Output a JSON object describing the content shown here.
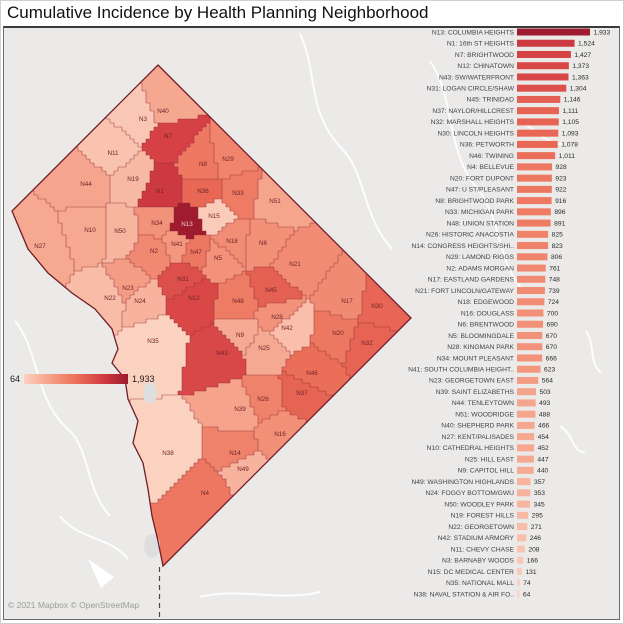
{
  "title": "Cumulative Incidence by Health Planning Neighborhood",
  "attribution": "© 2021 Mapbox © OpenStreetMap",
  "legend": {
    "min_label": "64",
    "max_label": "1,933"
  },
  "color_scale": {
    "stops": [
      "#fbd2c0",
      "#f5a088",
      "#ec7059",
      "#d43d43",
      "#9e1b30"
    ],
    "domain": [
      64,
      1933
    ]
  },
  "chart_data": {
    "type": "bar",
    "orientation": "horizontal",
    "title": "Cumulative Incidence by Health Planning Neighborhood",
    "xlabel": "",
    "ylabel": "",
    "xlim": [
      0,
      1933
    ],
    "grid": false,
    "legend_position": "none",
    "categories": [
      "N13: COLUMBIA HEIGHTS",
      "N1: 16th ST HEIGHTS",
      "N7: BRIGHTWOOD",
      "N12: CHINATOWN",
      "N43: SW/WATERFRONT",
      "N31: LOGAN CIRCLE/SHAW",
      "N45: TRINIDAD",
      "N37: NAYLOR/HILLCREST",
      "N32: MARSHALL HEIGHTS",
      "N30: LINCOLN HEIGHTS",
      "N36: PETWORTH",
      "N46: TWINING",
      "N4: BELLEVUE",
      "N20: FORT DUPONT",
      "N47: U ST/PLEASANT",
      "N8: BRIGHTWOOD PARK",
      "N33: MICHIGAN PARK",
      "N48: UNION STATION",
      "N26: HISTORIC ANACOSTIA",
      "N14: CONGRESS HEIGHTS/SHI..",
      "N29: LAMOND RIGGS",
      "N2: ADAMS MORGAN",
      "N17: EASTLAND GARDENS",
      "N21: FORT LINCOLN/GATEWAY",
      "N18: EDGEWOOD",
      "N16: DOUGLASS",
      "N6: BRENTWOOD",
      "N5: BLOOMINGDALE",
      "N28: KINGMAN PARK",
      "N34: MOUNT PLEASANT",
      "N41: SOUTH COLUMBIA HEIGHT..",
      "N23: GEORGETOWN EAST",
      "N39: SAINT ELIZABETHS",
      "N44: TENLEYTOWN",
      "N51: WOODRIDGE",
      "N40: SHEPHERD PARK",
      "N27: KENT/PALISADES",
      "N10: CATHEDRAL HEIGHTS",
      "N25: HILL EAST",
      "N9: CAPITOL HILL",
      "N49: WASHINGTON HIGHLANDS",
      "N24: FOGGY BOTTOM/GWU",
      "N50: WOODLEY PARK",
      "N19: FOREST HILLS",
      "N22: GEORGETOWN",
      "N42: STADIUM ARMORY",
      "N11: CHEVY CHASE",
      "N3: BARNABY WOODS",
      "N15: DC MEDICAL CENTER",
      "N35: NATIONAL MALL",
      "N38: NAVAL STATION & AIR FO.."
    ],
    "values": [
      1933,
      1524,
      1427,
      1373,
      1363,
      1304,
      1146,
      1111,
      1105,
      1093,
      1078,
      1011,
      928,
      923,
      922,
      916,
      896,
      891,
      825,
      823,
      806,
      761,
      748,
      739,
      724,
      700,
      690,
      670,
      670,
      666,
      623,
      564,
      503,
      493,
      488,
      466,
      454,
      452,
      447,
      440,
      357,
      353,
      345,
      295,
      271,
      246,
      208,
      166,
      131,
      74,
      64
    ]
  },
  "map": {
    "type": "choropleth",
    "outline": [
      [
        158,
        64
      ],
      [
        411,
        317
      ],
      [
        163,
        565
      ],
      [
        158,
        540
      ],
      [
        152,
        515
      ],
      [
        148,
        488
      ],
      [
        143,
        462
      ],
      [
        133,
        442
      ],
      [
        138,
        420
      ],
      [
        128,
        398
      ],
      [
        125,
        378
      ],
      [
        112,
        362
      ],
      [
        118,
        348
      ],
      [
        112,
        328
      ],
      [
        95,
        308
      ],
      [
        72,
        292
      ],
      [
        48,
        272
      ],
      [
        28,
        248
      ],
      [
        12,
        210
      ]
    ],
    "sites": [
      {
        "id": "N13",
        "x": 187,
        "y": 223,
        "value": 1933
      },
      {
        "id": "N1",
        "x": 160,
        "y": 190,
        "value": 1524
      },
      {
        "id": "N7",
        "x": 168,
        "y": 135,
        "value": 1427
      },
      {
        "id": "N12",
        "x": 194,
        "y": 297,
        "value": 1373
      },
      {
        "id": "N43",
        "x": 222,
        "y": 352,
        "value": 1363
      },
      {
        "id": "N31",
        "x": 183,
        "y": 278,
        "value": 1304
      },
      {
        "id": "N45",
        "x": 271,
        "y": 289,
        "value": 1146
      },
      {
        "id": "N37",
        "x": 302,
        "y": 392,
        "value": 1111
      },
      {
        "id": "N32",
        "x": 367,
        "y": 342,
        "value": 1105
      },
      {
        "id": "N30",
        "x": 377,
        "y": 305,
        "value": 1093
      },
      {
        "id": "N36",
        "x": 203,
        "y": 190,
        "value": 1078
      },
      {
        "id": "N46",
        "x": 312,
        "y": 372,
        "value": 1011
      },
      {
        "id": "N4",
        "x": 205,
        "y": 492,
        "value": 928
      },
      {
        "id": "N20",
        "x": 338,
        "y": 332,
        "value": 923
      },
      {
        "id": "N47",
        "x": 196,
        "y": 251,
        "value": 922
      },
      {
        "id": "N8",
        "x": 203,
        "y": 163,
        "value": 916
      },
      {
        "id": "N33",
        "x": 238,
        "y": 192,
        "value": 896
      },
      {
        "id": "N48",
        "x": 238,
        "y": 300,
        "value": 891
      },
      {
        "id": "N26",
        "x": 263,
        "y": 398,
        "value": 825
      },
      {
        "id": "N14",
        "x": 235,
        "y": 452,
        "value": 823
      },
      {
        "id": "N29",
        "x": 228,
        "y": 158,
        "value": 806
      },
      {
        "id": "N2",
        "x": 154,
        "y": 250,
        "value": 761
      },
      {
        "id": "N17",
        "x": 347,
        "y": 300,
        "value": 748
      },
      {
        "id": "N21",
        "x": 295,
        "y": 263,
        "value": 739
      },
      {
        "id": "N18",
        "x": 232,
        "y": 240,
        "value": 724
      },
      {
        "id": "N16",
        "x": 280,
        "y": 433,
        "value": 700
      },
      {
        "id": "N6",
        "x": 263,
        "y": 242,
        "value": 690
      },
      {
        "id": "N5",
        "x": 218,
        "y": 257,
        "value": 670
      },
      {
        "id": "N28",
        "x": 277,
        "y": 316,
        "value": 670
      },
      {
        "id": "N34",
        "x": 157,
        "y": 222,
        "value": 666
      },
      {
        "id": "N41",
        "x": 177,
        "y": 243,
        "value": 623
      },
      {
        "id": "N23",
        "x": 128,
        "y": 287,
        "value": 564
      },
      {
        "id": "N39",
        "x": 240,
        "y": 408,
        "value": 503
      },
      {
        "id": "N44",
        "x": 86,
        "y": 183,
        "value": 493
      },
      {
        "id": "N51",
        "x": 275,
        "y": 200,
        "value": 488
      },
      {
        "id": "N40",
        "x": 163,
        "y": 110,
        "value": 466
      },
      {
        "id": "N27",
        "x": 40,
        "y": 245,
        "value": 454
      },
      {
        "id": "N10",
        "x": 90,
        "y": 229,
        "value": 452
      },
      {
        "id": "N25",
        "x": 264,
        "y": 347,
        "value": 447
      },
      {
        "id": "N9",
        "x": 240,
        "y": 334,
        "value": 440
      },
      {
        "id": "N49",
        "x": 243,
        "y": 468,
        "value": 357
      },
      {
        "id": "N24",
        "x": 140,
        "y": 300,
        "value": 353
      },
      {
        "id": "N50",
        "x": 120,
        "y": 230,
        "value": 345
      },
      {
        "id": "N19",
        "x": 133,
        "y": 178,
        "value": 295
      },
      {
        "id": "N22",
        "x": 110,
        "y": 297,
        "value": 271
      },
      {
        "id": "N42",
        "x": 287,
        "y": 327,
        "value": 246
      },
      {
        "id": "N11",
        "x": 113,
        "y": 152,
        "value": 208
      },
      {
        "id": "N3",
        "x": 143,
        "y": 118,
        "value": 166
      },
      {
        "id": "N15",
        "x": 214,
        "y": 215,
        "value": 131
      },
      {
        "id": "N35",
        "x": 153,
        "y": 340,
        "value": 74
      },
      {
        "id": "N38",
        "x": 168,
        "y": 452,
        "value": 64
      }
    ]
  }
}
